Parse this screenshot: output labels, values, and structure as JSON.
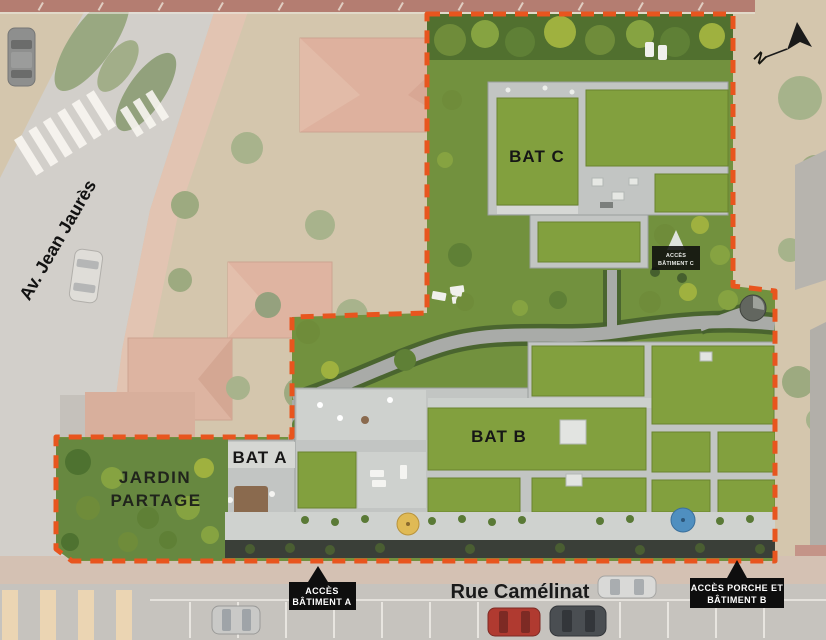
{
  "meta": {
    "view": "aerial-site-plan"
  },
  "compass": {
    "north_label": "N"
  },
  "streets": {
    "avenue_label": "Av. Jean Jaurès",
    "rue_label": "Rue Camélinat"
  },
  "buildings": {
    "bat_a_label": "BAT A",
    "bat_b_label": "BAT B",
    "bat_c_label": "BAT C"
  },
  "shared_garden": {
    "line1": "JARDIN",
    "line2": "PARTAGE"
  },
  "access_badges": {
    "batiment_a": {
      "line1": "ACCÈS",
      "line2": "BÂTIMENT A"
    },
    "porche_batiment_b": {
      "line1": "ACCÈS PORCHE ET",
      "line2": "BÂTIMENT B"
    },
    "batiment_c": {
      "line1": "ACCÈS",
      "line2": "BÂTIMENT C"
    }
  },
  "colors": {
    "site_boundary": "#e8551e",
    "roof_green": "#82a03e",
    "lawn_green": "#72913e",
    "building_gray": "#c2c5c3",
    "badge_bg": "#0e0e0e",
    "badge_text": "#ffffff",
    "neighbor_roof": "#d79d87",
    "road_gray": "#c7c5c3",
    "sidewalk_pink": "#dcb6a2",
    "label_text": "#1c1c1c"
  }
}
